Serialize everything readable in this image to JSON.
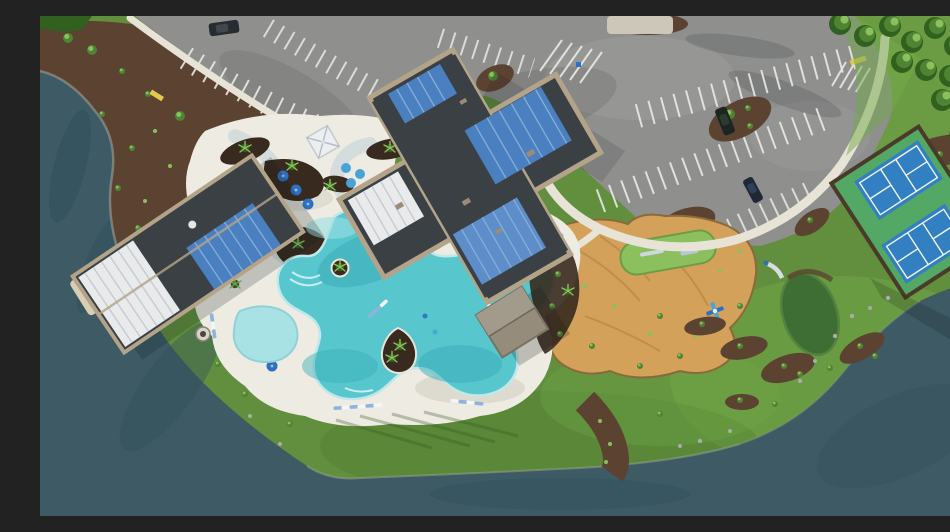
{
  "meta": {
    "label": "Aerial photograph of a lakeside resort-style amenity center with freeform pool, clubhouse, parking lot, pickleball courts and playground"
  },
  "palette": {
    "water": "#3d5a65",
    "waterDark": "#32505b",
    "grass": "#628f3d",
    "grassLight": "#74aa49",
    "grassDark": "#4e7c30",
    "mulch": "#5c4230",
    "mulchDark": "#382a1e",
    "asphalt": "#8f8f8d",
    "asphaltLight": "#9c9c9a",
    "stripe": "#e9e9e7",
    "sidewalk": "#e7e3d7",
    "riverWater": "#d4dddc",
    "deck": "#edebe2",
    "deckShadow": "#d8d7cc",
    "pool": "#57c6cd",
    "poolShallow": "#a9e2e5",
    "poolDeep": "#3aacb9",
    "dirt": "#d3a159",
    "dirtShade": "#bb8a47",
    "roofDark": "#3b4045",
    "roofTan": "#b3a489",
    "roofBlue": "#4b80c0",
    "roofBlueLight": "#86add8",
    "roofWhite": "#e8eaec",
    "roofWhiteLine": "#c4c9ce",
    "courtGreen": "#52a864",
    "courtBlue": "#327fc2",
    "courtLine": "#eef3f6",
    "puttingGreen": "#3f6e35",
    "tree": "#4e8433",
    "treeDark": "#31601f",
    "treeLight": "#8cc05e",
    "umbrella": "#2f6fc0",
    "umbrellaCyan": "#49a3d6",
    "chairWhite": "#f4f6f6",
    "chairBlue": "#8fb4da",
    "concretePad": "#ccc7b8",
    "sandPad": "#d9cdb4",
    "curbYellow": "#e3c94f",
    "rock": "#a8ada6",
    "carDark": "#262b30"
  },
  "scene": {
    "features": [
      "lake",
      "shoreline-mulch",
      "parking-lot",
      "parking-stripes",
      "parked-cars",
      "clubhouse-roof",
      "lakeside-building-roof",
      "gazebo",
      "pavilion",
      "pool-deck",
      "freeform-pool",
      "kiddie-pool",
      "lazy-river-area",
      "umbrellas",
      "lounge-chairs",
      "fire-pit",
      "pickleball-courts",
      "playground-dirt",
      "turf-patch",
      "putting-green",
      "playground-equipment",
      "tree-grove",
      "lawn",
      "sidewalks",
      "landscape-islands"
    ]
  }
}
